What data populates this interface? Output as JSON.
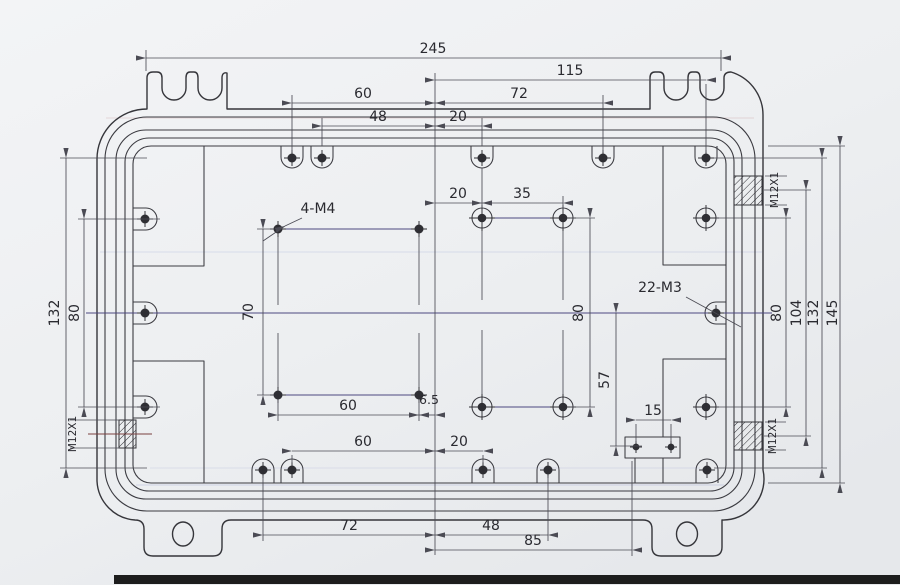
{
  "drawing": {
    "kind": "mechanical-engineering-drawing",
    "colors": {
      "paper": "#eef0f2",
      "ink": "#35353a",
      "dimension_ink": "#4b4b54",
      "centerline_tint": "#4c4880",
      "scan_band": "#1d1d1d"
    },
    "labels": {
      "dim_overall_width": "245",
      "dim_115": "115",
      "dim_top_60": "60",
      "dim_top_72": "72",
      "dim_top_48": "48",
      "dim_top_20": "20",
      "dim_mid_20": "20",
      "dim_mid_35": "35",
      "label_4_m4": "4-M4",
      "label_22_m3": "22-M3",
      "dim_70": "70",
      "dim_mid_80": "80",
      "dim_m4_60": "60",
      "dim_6_5": "6.5",
      "dim_57": "57",
      "dim_15": "15",
      "dim_bot_60": "60",
      "dim_bot_20": "20",
      "dim_bot_72": "72",
      "dim_bot_48": "48",
      "dim_bot_85": "85",
      "dim_left_132": "132",
      "dim_left_80": "80",
      "thread_left": "M12X1",
      "thread_right_top": "M12X1",
      "thread_right_bottom": "M12X1",
      "dim_right_80": "80",
      "dim_right_104": "104",
      "dim_right_132": "132",
      "dim_right_145": "145"
    }
  }
}
